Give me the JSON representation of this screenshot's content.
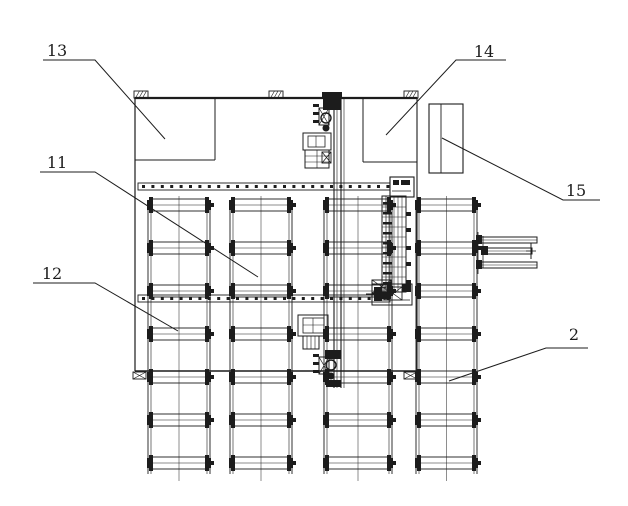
{
  "figure": {
    "background": "#ffffff",
    "ink": "#1c1c1c"
  },
  "labels": [
    {
      "id": "13",
      "text": "13"
    },
    {
      "id": "11",
      "text": "11"
    },
    {
      "id": "12",
      "text": "12"
    },
    {
      "id": "14",
      "text": "14"
    },
    {
      "id": "15",
      "text": "15"
    },
    {
      "id": "2",
      "text": "2"
    }
  ]
}
